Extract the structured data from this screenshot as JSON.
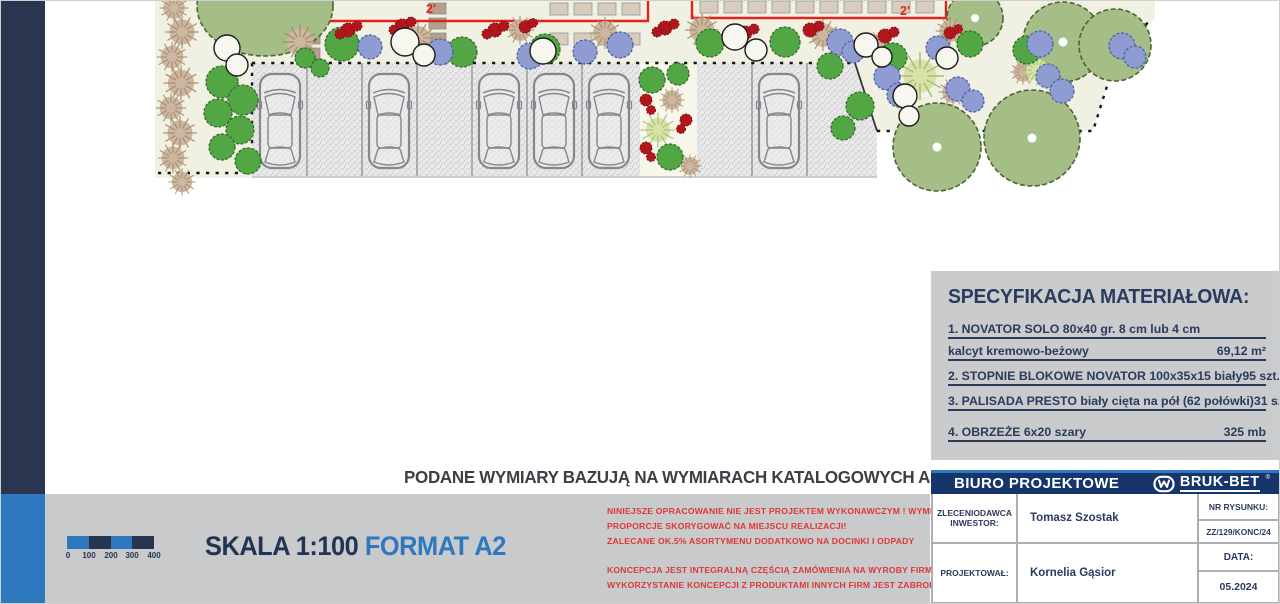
{
  "colors": {
    "accent_blue": "#2e78bf",
    "navy_text": "#2a3b5e",
    "titlebar_navy": "#16356a",
    "sidebar_navy": "#2a364f",
    "warning_red": "#dd3838",
    "plan_label_red": "#e0231d",
    "band_gray": "#c9cacb"
  },
  "plan": {
    "area_labels": [
      {
        "text": "2'"
      },
      {
        "text": "2'"
      }
    ]
  },
  "catalog_note": "PODANE WYMIARY BAZUJĄ NA WYMIARACH KATALOGOWYCH ASORTYMENTU !",
  "scale": {
    "title": "SKALA 1:100",
    "format": "FORMAT A2",
    "bar_labels": [
      "0",
      "100",
      "200",
      "300",
      "400"
    ]
  },
  "warnings": {
    "para1": [
      "NINIEJSZE OPRACOWANIE NIE JEST PROJEKTEM WYKONAWCZYM ! WYMIARY ORAZ",
      "PROPORCJE SKORYGOWAĆ NA MIEJSCU REALIZACJI!",
      "ZALECANE OK.5% ASORTYMENU DODATKOWO NA DOCINKI I ODPADY"
    ],
    "para2": [
      "KONCEPCJA JEST INTEGRALNĄ CZĘŚCIĄ ZAMÓWIENIA NA WYROBY FIRMY BRUK-BET",
      "WYKORZYSTANIE KONCEPCJI Z PRODUKTAMI INNYCH FIRM JEST ZABRONIONE!"
    ]
  },
  "spec": {
    "title": "SPECYFIKACJA MATERIAŁOWA:",
    "items": [
      {
        "name": "1. NOVATOR SOLO 80x40 gr. 8 cm lub 4 cm",
        "name2": "kalcyt kremowo-beżowy",
        "value": "69,12 m²"
      },
      {
        "name": "2. STOPNIE BLOKOWE NOVATOR 100x35x15 biały",
        "value": "95 szt."
      },
      {
        "name": "3. PALISADA PRESTO biały cięta na pół (62 połówki)",
        "value": "31 szt."
      },
      {
        "name": "4. OBRZEŻE 6x20 szary",
        "value": "325 mb"
      }
    ]
  },
  "title_block": {
    "office": "BIURO PROJEKTOWE",
    "brand": "BRUK-BET",
    "brand_mark": "®",
    "client_label": [
      "ZLECENIODAWCA",
      "INWESTOR:"
    ],
    "client": "Tomasz Szostak",
    "designer_label": "PROJEKTOWAŁ:",
    "designer": "Kornelia Gąsior",
    "drawing_no_label": "NR RYSUNKU:",
    "drawing_no": "ZZ/129/KONC/24",
    "date_label": "DATA:",
    "date": "05.2024"
  }
}
